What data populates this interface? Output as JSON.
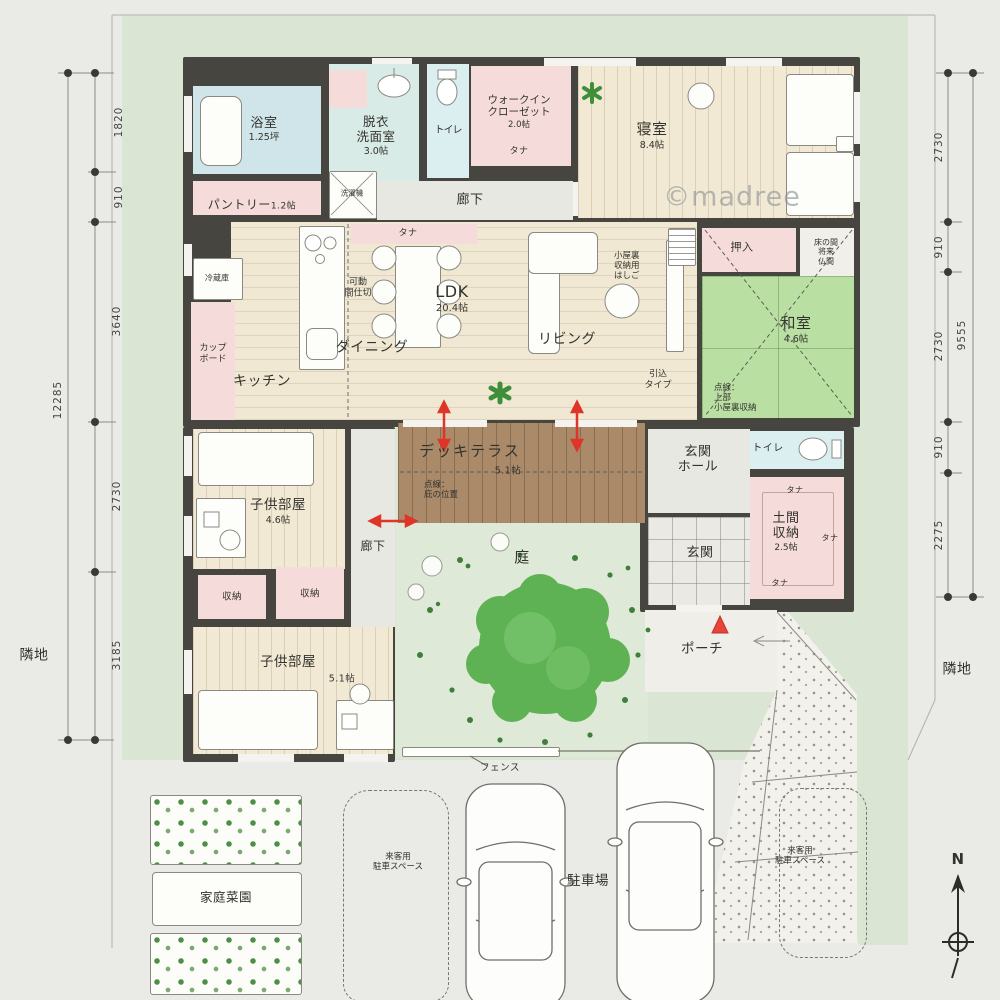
{
  "watermark": "©madree",
  "compass": {
    "north": "N"
  },
  "site": {
    "neighbor_left": "隣地",
    "neighbor_right": "隣地",
    "fence_label": "フェンス"
  },
  "rooms": {
    "bath": {
      "name": "浴室",
      "size": "1.25坪"
    },
    "pantry": {
      "name": "パントリー",
      "size": "1.2帖"
    },
    "datsui": {
      "name": "脱衣\n洗面室",
      "size": "3.0帖"
    },
    "washer": {
      "name": "洗濯機"
    },
    "toilet1": {
      "name": "トイレ"
    },
    "hall_top": {
      "name": "廊下"
    },
    "wic": {
      "name": "ウォークイン\nクローゼット",
      "size": "2.0帖"
    },
    "bedroom": {
      "name": "寝室",
      "size": "8.4帖"
    },
    "ldk": {
      "name": "LDK",
      "size": "20.4帖"
    },
    "kitchen": {
      "name": "キッチン"
    },
    "dining": {
      "name": "ダイニング"
    },
    "living": {
      "name": "リビング"
    },
    "fridge": {
      "name": "冷蔵庫"
    },
    "cupboard": {
      "name": "カップ\nボード"
    },
    "partition": {
      "name": "可動\n間仕切"
    },
    "tana": "タナ",
    "loft_ladder": "小屋裏\n収納用\nはしご",
    "sliding_door": "引込\nタイプ",
    "oshiire": {
      "name": "押入"
    },
    "tokonoma": {
      "name": "床の間\n将来\n仏間"
    },
    "washitsu": {
      "name": "和室",
      "size": "4.6帖",
      "note": "点線：\n上部\n小屋裏収納"
    },
    "deck": {
      "name": "デッキテラス",
      "size": "5.1帖",
      "note": "点線：\n庇の位置"
    },
    "genkan_hall": {
      "name": "玄関\nホール"
    },
    "genkan": {
      "name": "玄関"
    },
    "toilet2": {
      "name": "トイレ"
    },
    "doma": {
      "name": "土間\n収納",
      "size": "2.5帖"
    },
    "porch": {
      "name": "ポーチ"
    },
    "kids1": {
      "name": "子供部屋",
      "size": "4.6帖"
    },
    "hall_left": {
      "name": "廊下"
    },
    "sto1": {
      "name": "収納"
    },
    "sto2": {
      "name": "収納"
    },
    "kids2": {
      "name": "子供部屋",
      "size": "5.1帖"
    },
    "garden": {
      "name": "庭"
    }
  },
  "outdoor": {
    "veg_garden": "家庭菜園",
    "parking": "駐車場",
    "guest_parking1": "来客用\n駐車スペース",
    "guest_parking2": "来客用\n駐車スペース"
  },
  "dimensions": {
    "left_total": "12285",
    "left": [
      "1820",
      "910",
      "3640",
      "2730",
      "3185"
    ],
    "right_total": "9555",
    "right": [
      "2730",
      "910",
      "2730",
      "910",
      "2275"
    ]
  },
  "colors": {
    "accent_red": "#df3428",
    "tatami_green": "#badfa3",
    "deck_brown": "#aa8a69",
    "wood_floor": "#f2e9d5",
    "closet_pink": "#f5dcda",
    "bath_blue": "#cfe5e9",
    "site_green": "#dbe5d3"
  }
}
